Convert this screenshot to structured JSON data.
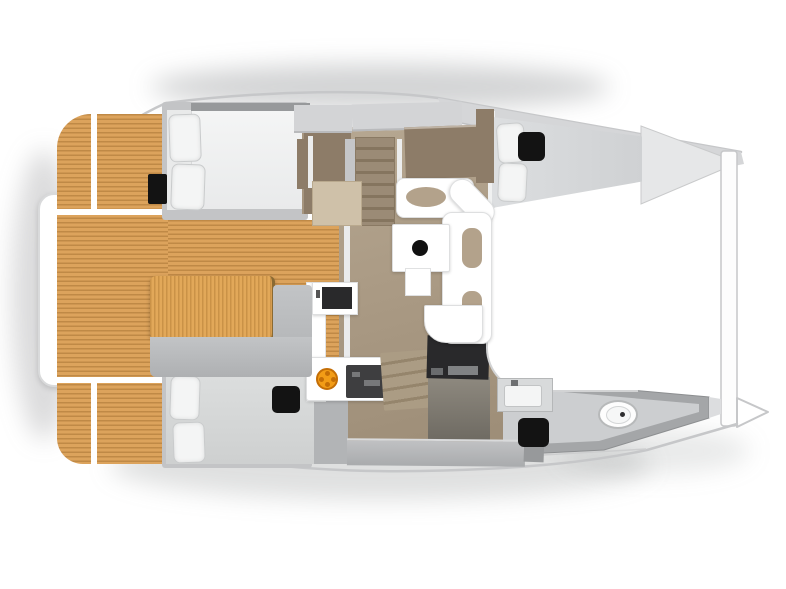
{
  "meta": {
    "width": 786,
    "height": 589,
    "description": "Top-down 3D floor plan of a catamaran interior, bow pointing right"
  },
  "colors": {
    "hull_line": "#c6c7c9",
    "deck_band": "#d5d6d8",
    "bow_interior": "#e6e7e8",
    "teak": "#dca35c",
    "wood_table": "#e2a859",
    "salon_floor": "#b0a08a",
    "cabinet_brown": "#8d7c68",
    "bench_gray": "#aeb0b2",
    "locker_gray": "#d3d4d6",
    "mattress_white": "#f2f3f3",
    "mattress_gray": "#d6d8d8",
    "pillow_white": "#f4f5f5",
    "hatch_black": "#131313",
    "worktop_black": "#29292b",
    "stove_orange": "#f29c16",
    "stove_orange_deep": "#c46e06",
    "cushion_tan": "#b3a28b",
    "stairs_wood": "#9b8b76",
    "stairs_wood_dark": "#85755f",
    "bath_wall": "#a4a6a8",
    "bath_floor": "#ccced0"
  },
  "vessel": {
    "stern": {
      "items": [
        "swim-platform",
        "transom-bench",
        "teak-side-deck",
        "teak-cockpit-floor"
      ]
    },
    "cockpit": {
      "items": [
        "cockpit-table",
        "l-shaped-bench"
      ]
    },
    "salon": {
      "items": [
        "overhead-lockers",
        "storage-cabinets",
        "chart-desk",
        "companionway-stairs-top",
        "companionway-stairs-bottom",
        "galley-island",
        "galley-counter",
        "gas-stove",
        "range-top",
        "black-worktop",
        "dinette-sofa",
        "dinette-table",
        "fruit-bowl"
      ]
    },
    "cabins": {
      "items": [
        "double-bed-aft-top",
        "double-bed-aft-bottom",
        "forward-berth-top"
      ]
    },
    "bathroom": {
      "items": [
        "washbasin-unit",
        "shower-hatch",
        "toilet"
      ]
    },
    "foredeck": {
      "items": [
        "coachroof",
        "forward-crossbeam",
        "bow-tip"
      ]
    }
  }
}
